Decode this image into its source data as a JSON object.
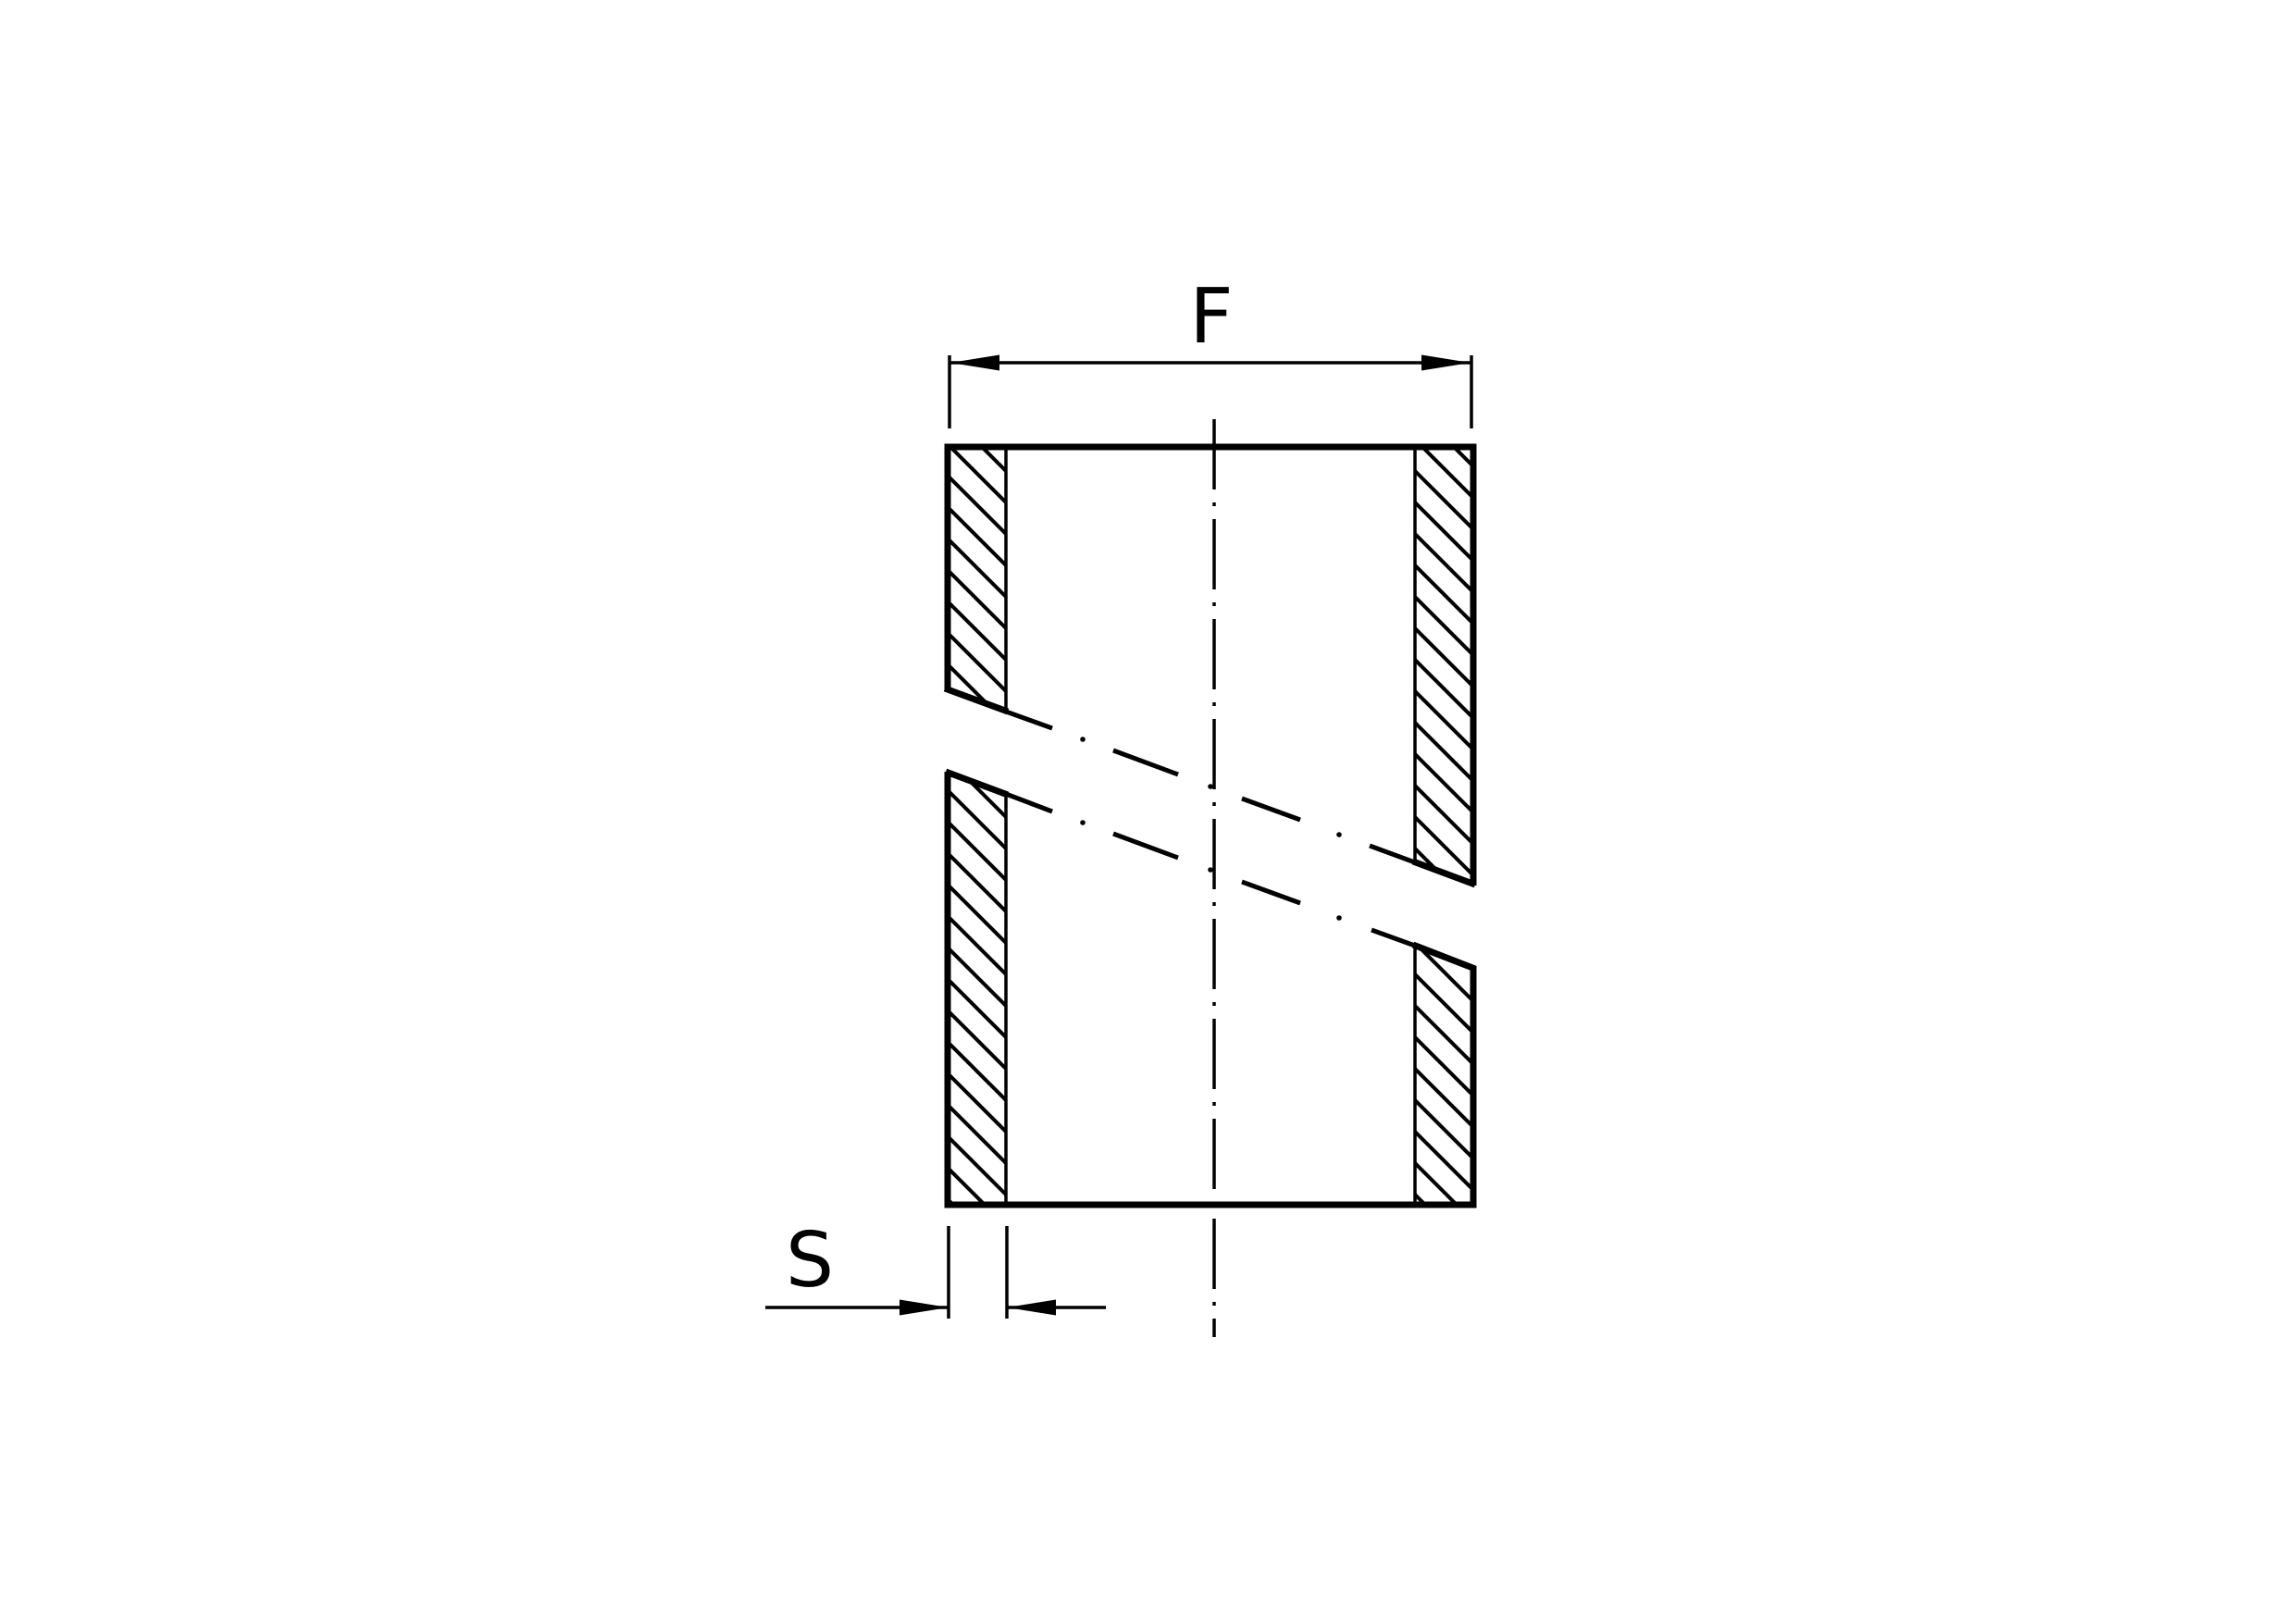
{
  "drawing": {
    "dimension_labels": {
      "width": "F",
      "wall_thickness": "S"
    },
    "colors": {
      "line": "#000000",
      "background": "#ffffff"
    }
  }
}
